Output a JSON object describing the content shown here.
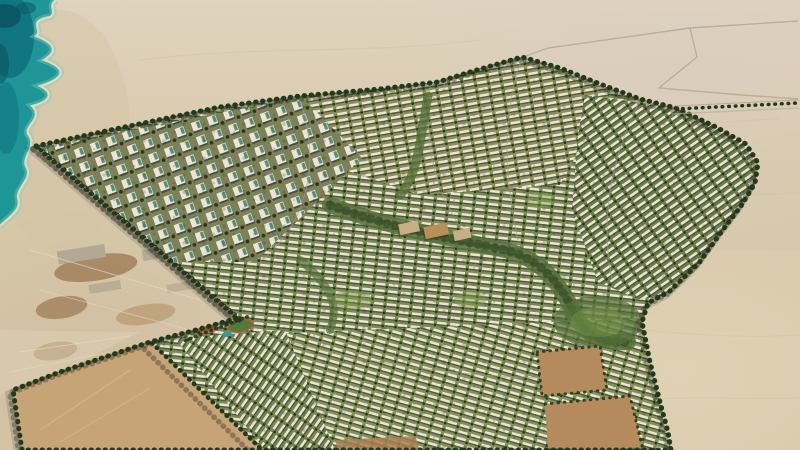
{
  "scene": {
    "title": "Aerial render of a coastal desert master-planned residential community",
    "camera": "high oblique aerial view, sun from upper right",
    "regions": {
      "sea": {
        "name": "sea",
        "position": "top-left corner",
        "description": "turquoise water with scalloped sandy shoreline and dark reef patches"
      },
      "beach_strip": {
        "name": "beach-strip",
        "description": "bare sand strip between shoreline and development with construction pads and brown graded patches"
      },
      "desert": {
        "name": "open-desert",
        "description": "flat tan desert surrounding the development with faint tracks"
      },
      "development": {
        "name": "masterplan-development",
        "description": "irregular polygon of dense housing rows, tree-lined boundary greenbelt"
      },
      "apartment_district": {
        "name": "apartment-district",
        "description": "cluster of white mid-rise towers with teal glass, northwest side"
      },
      "villa_districts": {
        "name": "villa-districts",
        "description": "curved rows of white townhouses and villas with street trees"
      },
      "central_park": {
        "name": "central-park-corridor",
        "description": "green landscaped spine winding through the middle"
      },
      "village_center": {
        "name": "village-center",
        "description": "tan low-rise commercial cluster at the heart"
      },
      "school": {
        "name": "school-campus",
        "description": "navy solar roofs, orange courtyard, pool and green sports field"
      },
      "vacant_sw_plot": {
        "name": "vacant-plot-southwest",
        "description": "large empty tan parcel framed by tree-lined roads"
      },
      "vacant_se_plots": {
        "name": "vacant-plots-southeast",
        "description": "brown future-phase parcels near the south boundary"
      },
      "boulevard": {
        "name": "western-boulevard",
        "description": "double tree-lined avenue along the west edge"
      },
      "east_road": {
        "name": "east-arterial-road",
        "description": "tree-dotted road leaving the northeast corner to the right edge"
      },
      "desert_roads": {
        "name": "faint-desert-roads",
        "description": "thin survey roads in the upper-right desert"
      }
    }
  },
  "colors": {
    "sea_mid": "#1e9697",
    "sea_deep": "#10717e",
    "sea_reef": "#0a5260",
    "sea_shallow": "#8cc8b6",
    "foam": "#ece2c6",
    "sand_base": "#d8c9ab",
    "sand_top": "#e2d6c4",
    "sand_pink": "#d9cdc0",
    "sand_dark": "#c6b292",
    "sand_bright": "#e6d8ba",
    "beach": "#d3c2a2",
    "scrape": "#e8dcc6",
    "construction_brown": "#9a7850",
    "construction_brown_light": "#b08c60",
    "pad_gray": "#b2a894",
    "road_faint": "#b9ac94",
    "road_gray": "#8f897a",
    "street_light": "#a09a89",
    "dev_base": "#8a9459",
    "rows_top_bg": "#8a9058",
    "rows_center_bg": "#7c8a54",
    "rows_right_bg": "#6e7d4a",
    "rows_bottom_bg": "#849257",
    "rows_sw_bg": "#77864f",
    "towers_bg": "#7d8157",
    "house_white": "#ece5d4",
    "house_shadow": "#4e5244",
    "tower_shadow": "#474c45",
    "tower_glass": "#4f8d7d",
    "tree_dark": "#24381c",
    "green_mid": "#55703a",
    "green_light": "#7d9a4c",
    "village_tan": "#c8ae85",
    "village_ochre": "#b98e58",
    "plot_tan": "#c6a478",
    "plot_streak": "#d6ba8e",
    "plot_brown": "#b58a5c",
    "strip_brown": "#a87f52",
    "school_navy": "#2c3d55",
    "school_white": "#eef0ee",
    "school_orange": "#c96a2e",
    "pool_teal": "#2e9daa",
    "field_green": "#4e7c3a",
    "track_red": "#ab5a35",
    "texture_line": "#cfc0a2",
    "shadow": "#23261c"
  }
}
